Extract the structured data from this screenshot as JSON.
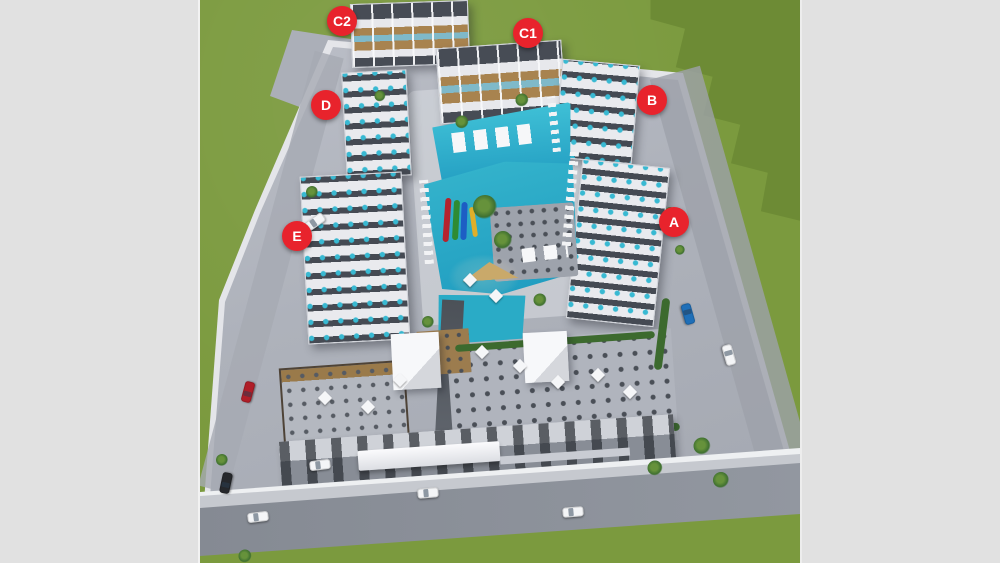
{
  "view": {
    "background_color": "#e1e1e1"
  },
  "site_plan": {
    "badge_color": "#e8232c",
    "badge_text_color": "#ffffff",
    "badges": [
      {
        "label": "C2",
        "x": 142,
        "y": 21
      },
      {
        "label": "C1",
        "x": 328,
        "y": 33
      },
      {
        "label": "D",
        "x": 126,
        "y": 105
      },
      {
        "label": "B",
        "x": 452,
        "y": 100
      },
      {
        "label": "E",
        "x": 97,
        "y": 236
      },
      {
        "label": "A",
        "x": 474,
        "y": 222
      }
    ],
    "palette": {
      "grass": "#7b9a3e",
      "grass_shadow": "#6c8a34",
      "concrete": "#aeb2bb",
      "road": "#8d929b",
      "building_light": "#e9eaed",
      "building_dark": "#454a53",
      "deck_wood": "#a8834f",
      "pool_water": "#2fb0c9",
      "slide_colors": [
        "#b5232d",
        "#2e8b33",
        "#1d5ec4",
        "#dfaf2a"
      ]
    },
    "cars": [
      {
        "name": "car-white",
        "color": "#f4f5f7",
        "x": 115,
        "y": 222,
        "rotate": -35
      },
      {
        "name": "car-red",
        "color": "#b01e28",
        "x": 48,
        "y": 392,
        "rotate": -75
      },
      {
        "name": "car-black",
        "color": "#26282c",
        "x": 26,
        "y": 483,
        "rotate": -78
      },
      {
        "name": "car-white",
        "color": "#f4f5f7",
        "x": 120,
        "y": 465,
        "rotate": -7
      },
      {
        "name": "car-white",
        "color": "#f4f5f7",
        "x": 58,
        "y": 517,
        "rotate": -7
      },
      {
        "name": "car-white",
        "color": "#f4f5f7",
        "x": 228,
        "y": 493,
        "rotate": -5
      },
      {
        "name": "car-white",
        "color": "#f4f5f7",
        "x": 373,
        "y": 512,
        "rotate": -5
      },
      {
        "name": "car-blue",
        "color": "#1f6fb8",
        "x": 488,
        "y": 314,
        "rotate": 74
      },
      {
        "name": "car-white",
        "color": "#f4f5f7",
        "x": 529,
        "y": 355,
        "rotate": 74
      }
    ],
    "palms": [
      {
        "name": "palm-tree",
        "x": 285,
        "y": 207,
        "s": 24
      },
      {
        "name": "palm-tree",
        "x": 303,
        "y": 240,
        "s": 18
      },
      {
        "name": "palm-tree",
        "x": 262,
        "y": 122,
        "s": 13
      },
      {
        "name": "palm-tree",
        "x": 322,
        "y": 100,
        "s": 13
      },
      {
        "name": "palm-tree",
        "x": 180,
        "y": 96,
        "s": 11
      },
      {
        "name": "palm-tree",
        "x": 112,
        "y": 192,
        "s": 12
      },
      {
        "name": "palm-tree",
        "x": 22,
        "y": 460,
        "s": 12
      },
      {
        "name": "palm-tree",
        "x": 45,
        "y": 556,
        "s": 13
      },
      {
        "name": "palm-tree",
        "x": 502,
        "y": 446,
        "s": 17
      },
      {
        "name": "palm-tree",
        "x": 521,
        "y": 480,
        "s": 16
      },
      {
        "name": "palm-tree",
        "x": 455,
        "y": 468,
        "s": 15
      },
      {
        "name": "palm-tree",
        "x": 340,
        "y": 300,
        "s": 13
      },
      {
        "name": "palm-tree",
        "x": 228,
        "y": 322,
        "s": 12
      },
      {
        "name": "palm-tree",
        "x": 470,
        "y": 212,
        "s": 10
      },
      {
        "name": "palm-tree",
        "x": 480,
        "y": 250,
        "s": 10
      }
    ],
    "umbrellas": [
      {
        "name": "umbrella-canopy",
        "x": 125,
        "y": 398
      },
      {
        "name": "umbrella-canopy",
        "x": 168,
        "y": 407
      },
      {
        "name": "umbrella-canopy",
        "x": 200,
        "y": 380
      },
      {
        "name": "umbrella-canopy",
        "x": 282,
        "y": 352
      },
      {
        "name": "umbrella-canopy",
        "x": 320,
        "y": 366
      },
      {
        "name": "umbrella-canopy",
        "x": 358,
        "y": 382
      },
      {
        "name": "umbrella-canopy",
        "x": 398,
        "y": 375
      },
      {
        "name": "umbrella-canopy",
        "x": 430,
        "y": 392
      },
      {
        "name": "umbrella-canopy",
        "x": 270,
        "y": 280
      },
      {
        "name": "umbrella-canopy",
        "x": 296,
        "y": 296
      }
    ]
  }
}
